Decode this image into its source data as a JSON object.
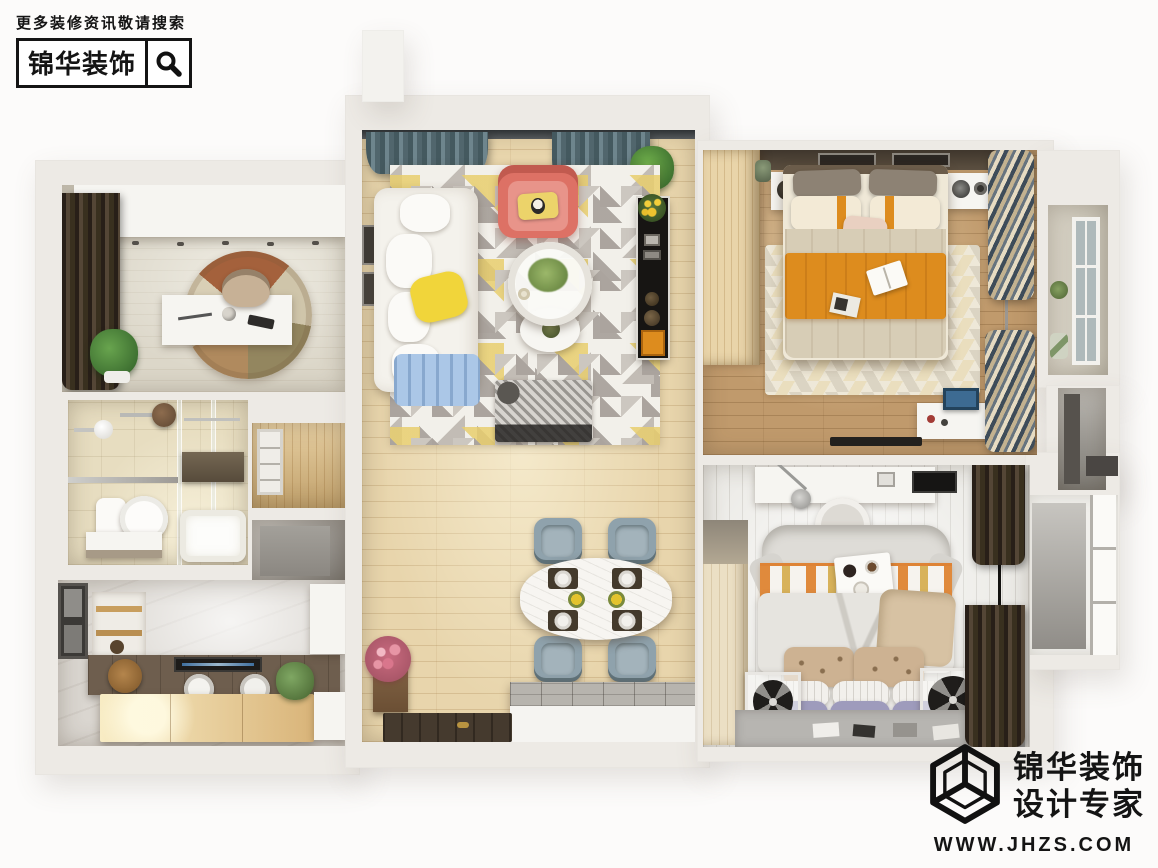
{
  "watermark_top": {
    "caption": "更多装修资讯敬请搜索",
    "brand": "锦华装饰"
  },
  "watermark_bottom": {
    "brand_line1": "锦华装饰",
    "brand_line2": "设计专家",
    "website": "WWW.JHZS.COM"
  },
  "scene": {
    "description": "top-down 3d render of a two-bedroom apartment",
    "rooms": [
      "study",
      "bathroom",
      "hallway-niches",
      "kitchen",
      "living-dining-room",
      "master-bedroom",
      "second-bedroom",
      "balcony"
    ]
  },
  "colors": {
    "ink": "#141414",
    "wall": "#edeae5",
    "floor-study": "#dcd7c9",
    "floor-bath": "#e7ddc0",
    "floor-kitchen": "#dad6d0",
    "floor-living": "#e8d5ac",
    "floor-master": "#c09a6c",
    "floor-bed2": "#edece8",
    "accent-red": "#dd7165",
    "accent-yellow": "#f1d53a",
    "accent-blue": "#abc7e7",
    "accent-orange": "#dd8c1e",
    "chair-gray": "#8fa2ac",
    "lavender": "#9e9bbc",
    "counter-dark": "#6e5e4e",
    "tv-black": "#171513"
  }
}
